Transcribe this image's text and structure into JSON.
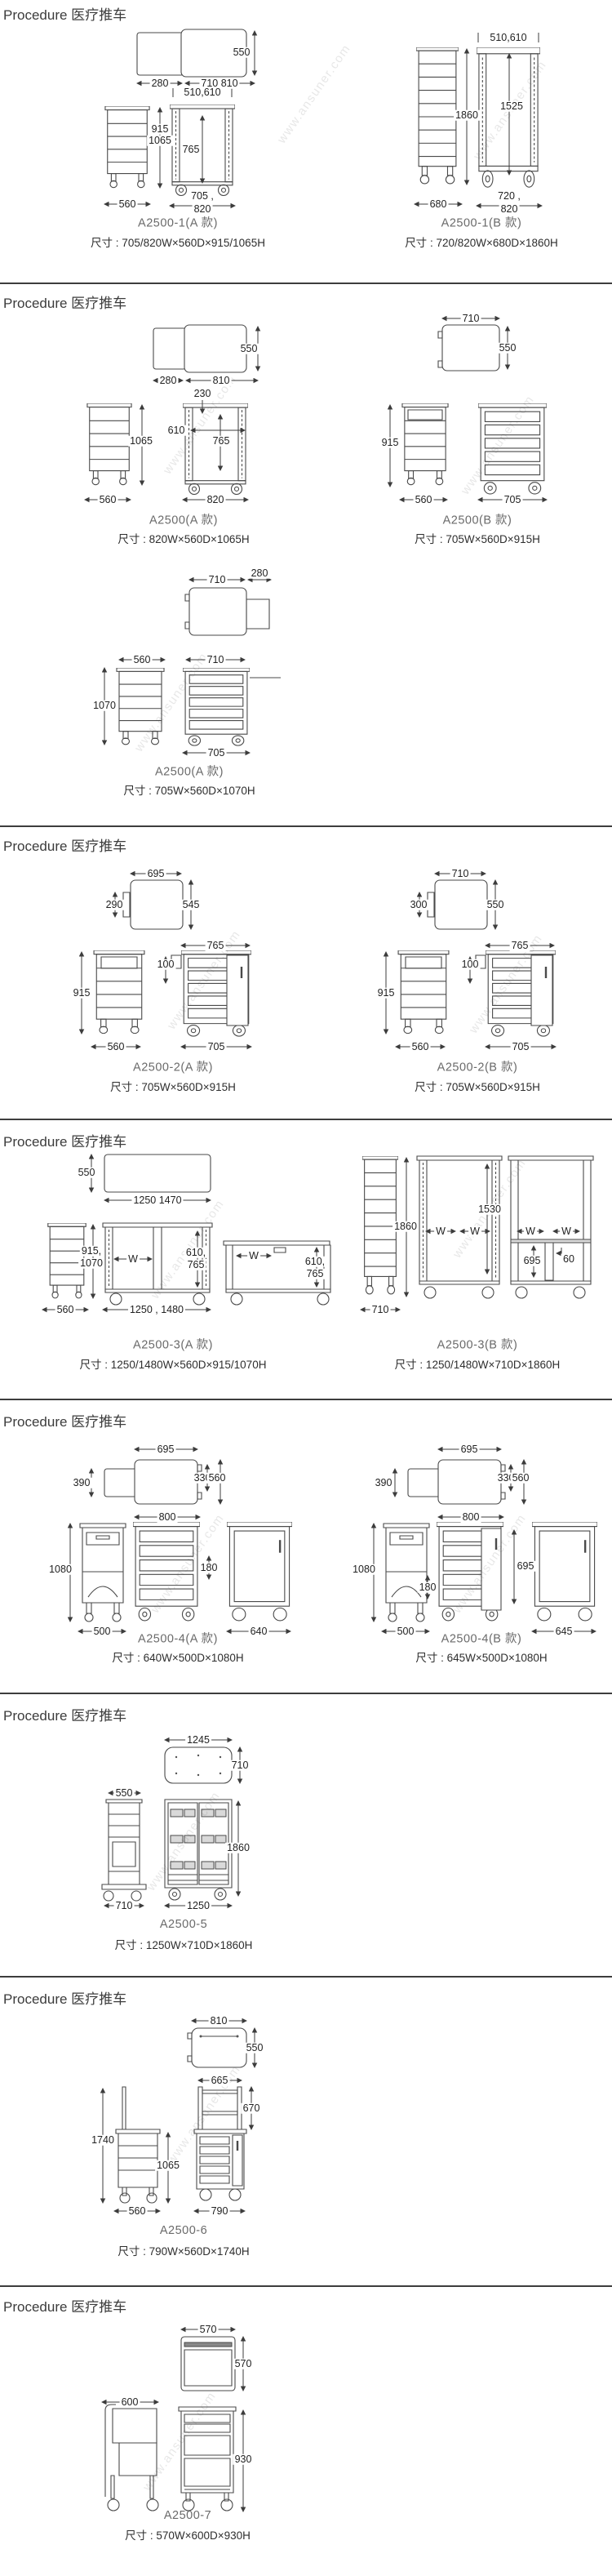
{
  "page": {
    "watermark": "www.ansuner.com"
  },
  "sections": [
    {
      "header": "Procedure 医疗推车",
      "models": [
        {
          "name": "A2500-1(A 款)",
          "size": "尺寸 : 705/820W×560D×915/1065H",
          "dims": [
            "550",
            "280",
            "710 810",
            "510,610",
            "915",
            "1065",
            "765",
            "560",
            "705 ,",
            "820"
          ]
        },
        {
          "name": "A2500-1(B 款)",
          "size": "尺寸 : 720/820W×680D×1860H",
          "dims": [
            "510,610",
            "1860",
            "1525",
            "680",
            "720 ,",
            "820"
          ]
        }
      ]
    },
    {
      "header": "Procedure 医疗推车",
      "models": [
        {
          "name": "A2500(A 款)",
          "size": "尺寸 : 820W×560D×1065H",
          "dims": [
            "550",
            "280",
            "810",
            "230",
            "1065",
            "610",
            "765",
            "560",
            "820"
          ]
        },
        {
          "name": "A2500(B 款)",
          "size": "尺寸 : 705W×560D×915H",
          "dims": [
            "710",
            "550",
            "915",
            "560",
            "705"
          ]
        },
        {
          "name": "A2500(A 款)",
          "size": "尺寸 : 705W×560D×1070H",
          "dims": [
            "710",
            "280",
            "560",
            "710",
            "1070",
            "705"
          ]
        }
      ]
    },
    {
      "header": "Procedure 医疗推车",
      "models": [
        {
          "name": "A2500-2(A 款)",
          "size": "尺寸 : 705W×560D×915H",
          "dims": [
            "695",
            "290",
            "545",
            "765",
            "100",
            "915",
            "560",
            "705"
          ]
        },
        {
          "name": "A2500-2(B 款)",
          "size": "尺寸 : 705W×560D×915H",
          "dims": [
            "710",
            "300",
            "550",
            "765",
            "100",
            "915",
            "560",
            "705"
          ]
        }
      ]
    },
    {
      "header": "Procedure 医疗推车",
      "models": [
        {
          "name": "A2500-3(A 款)",
          "size": "尺寸 : 1250/1480W×560D×915/1070H",
          "dims": [
            "550",
            "1250 1470",
            "915,",
            "1070",
            "W",
            "610,",
            "765",
            "W",
            "610,",
            "765",
            "560",
            "1250 , 1480"
          ]
        },
        {
          "name": "A2500-3(B 款)",
          "size": "尺寸 : 1250/1480W×710D×1860H",
          "dims": [
            "1860",
            "1530",
            "W",
            "W",
            "W",
            "W",
            "695",
            "60",
            "710"
          ]
        }
      ]
    },
    {
      "header": "Procedure 医疗推车",
      "models": [
        {
          "name": "A2500-4(A 款)",
          "size": "尺寸 : 640W×500D×1080H",
          "dims": [
            "695",
            "390",
            "330",
            "560",
            "800",
            "1080",
            "180",
            "500",
            "640"
          ]
        },
        {
          "name": "A2500-4(B 款)",
          "size": "尺寸 : 645W×500D×1080H",
          "dims": [
            "695",
            "390",
            "330",
            "560",
            "800",
            "1080",
            "180",
            "695",
            "500",
            "645"
          ]
        }
      ]
    },
    {
      "header": "Procedure 医疗推车",
      "models": [
        {
          "name": "A2500-5",
          "size": "尺寸 : 1250W×710D×1860H",
          "dims": [
            "1245",
            "710",
            "550",
            "1860",
            "710",
            "1250"
          ]
        }
      ]
    },
    {
      "header": "Procedure 医疗推车",
      "models": [
        {
          "name": "A2500-6",
          "size": "尺寸 : 790W×560D×1740H",
          "dims": [
            "810",
            "550",
            "665",
            "670",
            "1740",
            "1065",
            "560",
            "790"
          ]
        }
      ]
    },
    {
      "header": "Procedure 医疗推车",
      "models": [
        {
          "name": "A2500-7",
          "size": "尺寸 : 570W×600D×930H",
          "dims": [
            "570",
            "570",
            "600",
            "930"
          ]
        }
      ]
    }
  ]
}
